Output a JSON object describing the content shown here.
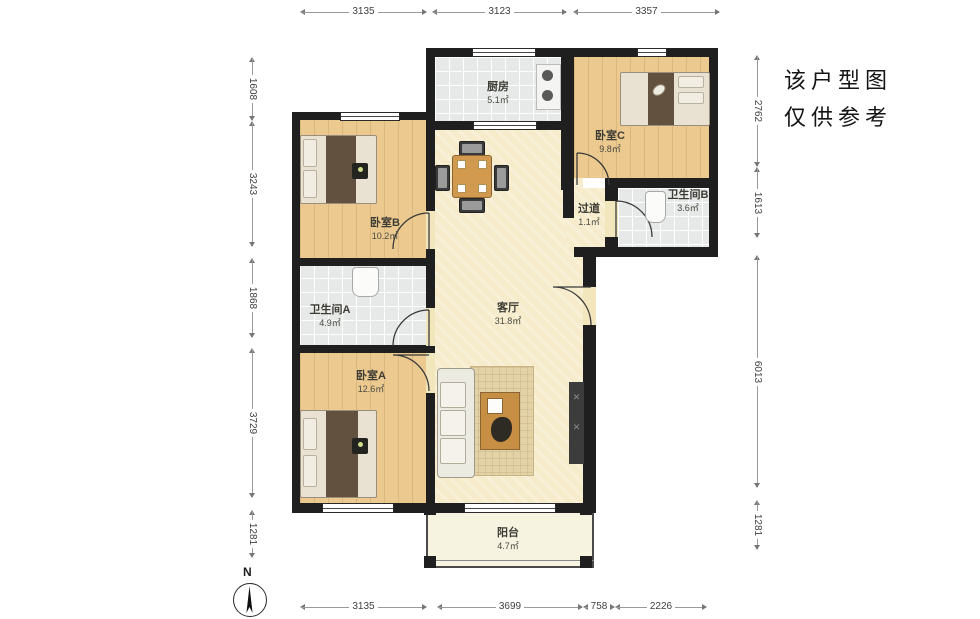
{
  "annotation": {
    "line1": "该户型图",
    "line2": "仅供参考"
  },
  "compass": {
    "label": "N"
  },
  "watermark": "lianjia",
  "rooms": {
    "kitchen": {
      "name": "厨房",
      "area": "5.1㎡"
    },
    "bedroom_c": {
      "name": "卧室C",
      "area": "9.8㎡"
    },
    "bathroom_b": {
      "name": "卫生间B",
      "area": "3.6㎡"
    },
    "corridor": {
      "name": "过道",
      "area": "1.1㎡"
    },
    "bedroom_b": {
      "name": "卧室B",
      "area": "10.2㎡"
    },
    "bathroom_a": {
      "name": "卫生间A",
      "area": "4.9㎡"
    },
    "living": {
      "name": "客厅",
      "area": "31.8㎡"
    },
    "bedroom_a": {
      "name": "卧室A",
      "area": "12.6㎡"
    },
    "balcony": {
      "name": "阳台",
      "area": "4.7㎡"
    }
  },
  "dims": {
    "top": [
      "3135",
      "3123",
      "3357"
    ],
    "bottom": [
      "3135",
      "3699",
      "758",
      "2226"
    ],
    "left": [
      "1608",
      "3243",
      "1868",
      "3729",
      "1281"
    ],
    "right": [
      "2762",
      "1613",
      "6013",
      "1281"
    ]
  }
}
